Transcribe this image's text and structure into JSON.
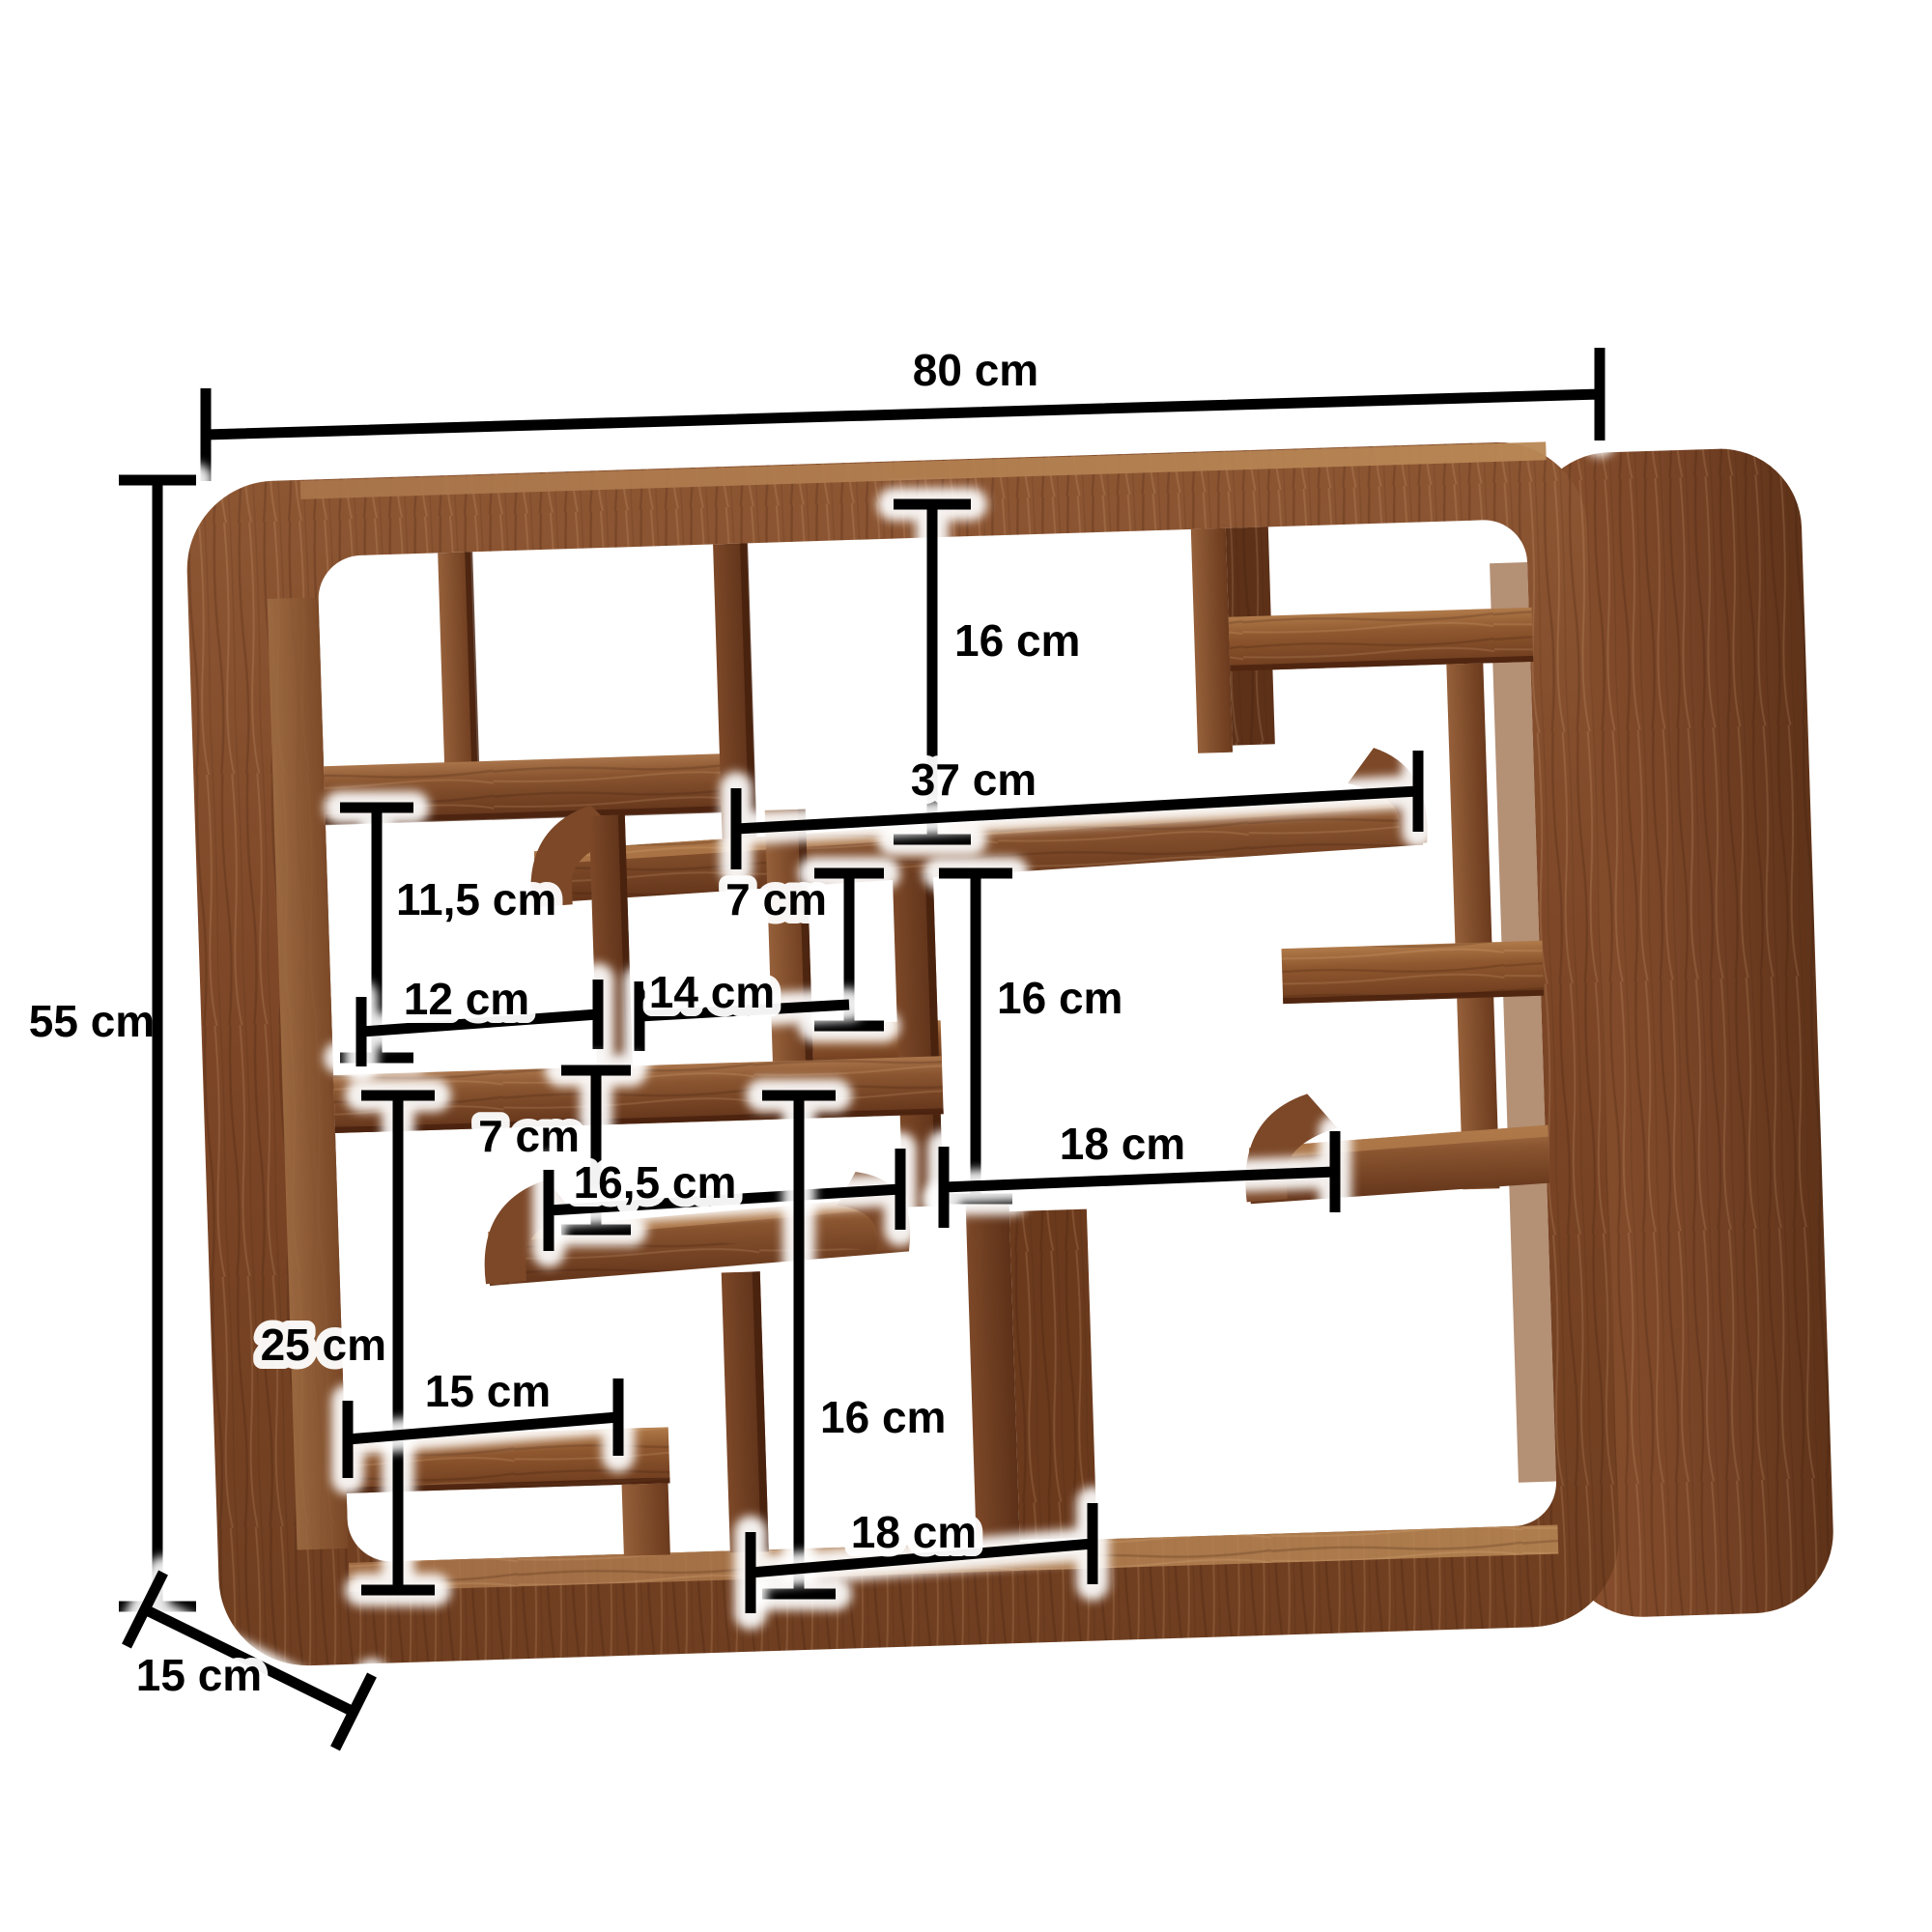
{
  "diagram": {
    "type": "furniture-dimension-diagram",
    "subject": "wall-shelf-with-compartments",
    "unit": "cm",
    "background_color": "#ffffff",
    "annotation_color": "#000000",
    "halo_color": "#ffffff",
    "wood_palette": {
      "face": "#83492a",
      "face_light": "#9a6138",
      "top_surface": "#b07a4a",
      "inner_face": "#9c6a42",
      "side_panel": "#7c4526",
      "dark_edge": "#451f0c"
    },
    "dimensions": {
      "total_width": {
        "label": "80 cm",
        "value": 80,
        "axis": "horizontal"
      },
      "total_height": {
        "label": "55 cm",
        "value": 55,
        "axis": "vertical"
      },
      "total_depth": {
        "label": "15 cm",
        "value": 15,
        "axis": "diagonal"
      },
      "top_opening_height": {
        "label": "16 cm",
        "value": 16,
        "axis": "vertical"
      },
      "middle_shelf_width": {
        "label": "37 cm",
        "value": 37,
        "axis": "horizontal"
      },
      "left_opening_height": {
        "label": "11,5 cm",
        "value": 11.5,
        "axis": "vertical"
      },
      "upper_small_height": {
        "label": "7 cm",
        "value": 7,
        "axis": "vertical"
      },
      "left_opening_width": {
        "label": "12 cm",
        "value": 12,
        "axis": "horizontal"
      },
      "center_left_width": {
        "label": "14 cm",
        "value": 14,
        "axis": "horizontal"
      },
      "center_opening_height": {
        "label": "16 cm",
        "value": 16,
        "axis": "vertical"
      },
      "lower_small_height": {
        "label": "7 cm",
        "value": 7,
        "axis": "vertical"
      },
      "lower_shelf_width": {
        "label": "16,5 cm",
        "value": 16.5,
        "axis": "horizontal"
      },
      "center_opening_width": {
        "label": "18 cm",
        "value": 18,
        "axis": "horizontal"
      },
      "bottom_left_height": {
        "label": "25 cm",
        "value": 25,
        "axis": "vertical"
      },
      "bottom_left_width": {
        "label": "15 cm",
        "value": 15,
        "axis": "horizontal"
      },
      "bottom_center_height": {
        "label": "16 cm",
        "value": 16,
        "axis": "vertical"
      },
      "bottom_center_width": {
        "label": "18 cm",
        "value": 18,
        "axis": "horizontal"
      }
    }
  }
}
